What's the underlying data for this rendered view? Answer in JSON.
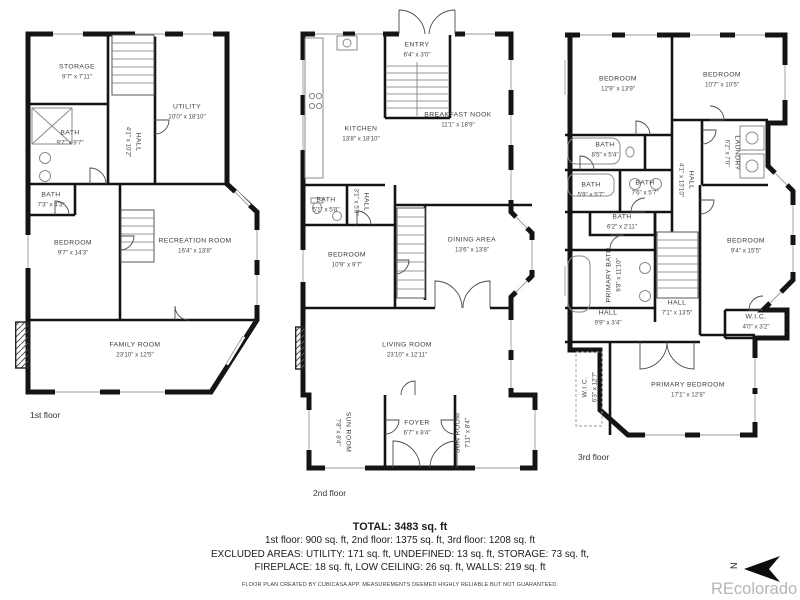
{
  "watermark": {
    "text": "REcolorado"
  },
  "compass": {
    "label": "N"
  },
  "floors": [
    {
      "caption": "1st floor",
      "rooms": [
        {
          "name": "STORAGE",
          "dims": "9'7\" x 7'11\"",
          "x": 62,
          "y": 52,
          "rot": 0
        },
        {
          "name": "UTILITY",
          "dims": "10'0\" x 18'10\"",
          "x": 172,
          "y": 92,
          "rot": 0
        },
        {
          "name": "BATH",
          "dims": "9'7\" x 9'7\"",
          "x": 55,
          "y": 118,
          "rot": 0
        },
        {
          "name": "HALL",
          "dims": "4'1\" x 10'2\"",
          "x": 118,
          "y": 122,
          "rot": 90
        },
        {
          "name": "BATH",
          "dims": "7'3\" x 4'3\"",
          "x": 36,
          "y": 180,
          "rot": 0
        },
        {
          "name": "BEDROOM",
          "dims": "9'7\" x 14'3\"",
          "x": 58,
          "y": 228,
          "rot": 0
        },
        {
          "name": "RECREATION ROOM",
          "dims": "16'4\" x 13'8\"",
          "x": 180,
          "y": 226,
          "rot": 0
        },
        {
          "name": "FAMILY ROOM",
          "dims": "23'10\" x 12'5\"",
          "x": 120,
          "y": 330,
          "rot": 0
        }
      ]
    },
    {
      "caption": "2nd floor",
      "rooms": [
        {
          "name": "ENTRY",
          "dims": "6'4\" x 3'0\"",
          "x": 122,
          "y": 30,
          "rot": 0
        },
        {
          "name": "KITCHEN",
          "dims": "13'8\" x 18'10\"",
          "x": 66,
          "y": 114,
          "rot": 0
        },
        {
          "name": "BREAKFAST NOOK",
          "dims": "11'1\" x 18'9\"",
          "x": 163,
          "y": 100,
          "rot": 0
        },
        {
          "name": "BATH",
          "dims": "5'1\" x 5'8\"",
          "x": 31,
          "y": 185,
          "rot": 0
        },
        {
          "name": "HALL",
          "dims": "3'1\" x 5'8\"",
          "x": 66,
          "y": 182,
          "rot": 90
        },
        {
          "name": "BEDROOM",
          "dims": "10'9\" x 9'7\"",
          "x": 52,
          "y": 240,
          "rot": 0
        },
        {
          "name": "DINING AREA",
          "dims": "13'6\" x 13'8\"",
          "x": 177,
          "y": 225,
          "rot": 0
        },
        {
          "name": "LIVING ROOM",
          "dims": "23'10\" x 12'11\"",
          "x": 112,
          "y": 330,
          "rot": 0
        },
        {
          "name": "SUN ROOM",
          "dims": "7'8\" x 8'4\"",
          "x": 48,
          "y": 412,
          "rot": 90
        },
        {
          "name": "FOYER",
          "dims": "6'7\" x 8'4\"",
          "x": 122,
          "y": 408,
          "rot": 0
        },
        {
          "name": "SUN ROOM",
          "dims": "7'11\" x 8'4\"",
          "x": 168,
          "y": 413,
          "rot": -90
        }
      ]
    },
    {
      "caption": "3rd floor",
      "rooms": [
        {
          "name": "BEDROOM",
          "dims": "12'9\" x 13'9\"",
          "x": 68,
          "y": 64,
          "rot": 0
        },
        {
          "name": "BEDROOM",
          "dims": "10'7\" x 10'5\"",
          "x": 172,
          "y": 60,
          "rot": 0
        },
        {
          "name": "BATH",
          "dims": "8'5\" x 5'4\"",
          "x": 55,
          "y": 130,
          "rot": 0
        },
        {
          "name": "LAUNDRY",
          "dims": "6'2\" x 7'0\"",
          "x": 182,
          "y": 133,
          "rot": 90
        },
        {
          "name": "BATH",
          "dims": "5'9\" x 5'7\"",
          "x": 41,
          "y": 170,
          "rot": 0
        },
        {
          "name": "BATH",
          "dims": "7'6\" x 5'7\"",
          "x": 95,
          "y": 168,
          "rot": 0
        },
        {
          "name": "HALL",
          "dims": "4'1\" x 13'10\"",
          "x": 136,
          "y": 160,
          "rot": 90
        },
        {
          "name": "BATH",
          "dims": "6'2\" x 2'11\"",
          "x": 72,
          "y": 202,
          "rot": 0
        },
        {
          "name": "PRIMARY BATH",
          "dims": "9'8\" x 11'10\"",
          "x": 64,
          "y": 255,
          "rot": -90
        },
        {
          "name": "BEDROOM",
          "dims": "9'4\" x 15'5\"",
          "x": 196,
          "y": 226,
          "rot": 0
        },
        {
          "name": "HALL",
          "dims": "7'1\" x 13'5\"",
          "x": 127,
          "y": 288,
          "rot": 0
        },
        {
          "name": "HALL",
          "dims": "9'9\" x 3'4\"",
          "x": 58,
          "y": 298,
          "rot": 0
        },
        {
          "name": "W.I.C.",
          "dims": "4'0\" x 3'2\"",
          "x": 206,
          "y": 302,
          "rot": 0
        },
        {
          "name": "W.I.C.",
          "dims": "6'3\" x 12'7\"",
          "x": 40,
          "y": 367,
          "rot": -90
        },
        {
          "name": "PRIMARY BEDROOM",
          "dims": "17'1\" x 12'8\"",
          "x": 138,
          "y": 370,
          "rot": 0
        }
      ]
    }
  ],
  "summary": {
    "total": "TOTAL: 3483 sq. ft",
    "floor_totals": "1st floor: 900 sq. ft, 2nd floor: 1375 sq. ft, 3rd floor: 1208 sq. ft",
    "excluded_line1": "EXCLUDED AREAS: UTILITY: 171 sq. ft, UNDEFINED: 13 sq. ft, STORAGE: 73 sq. ft,",
    "excluded_line2": "FIREPLACE: 18 sq. ft, LOW CEILING: 26 sq. ft, WALLS: 219 sq. ft",
    "disclaimer": "FLOOR PLAN CREATED BY CUBICASA APP. MEASUREMENTS DEEMED HIGHLY RELIABLE BUT NOT GUARANTEED."
  }
}
